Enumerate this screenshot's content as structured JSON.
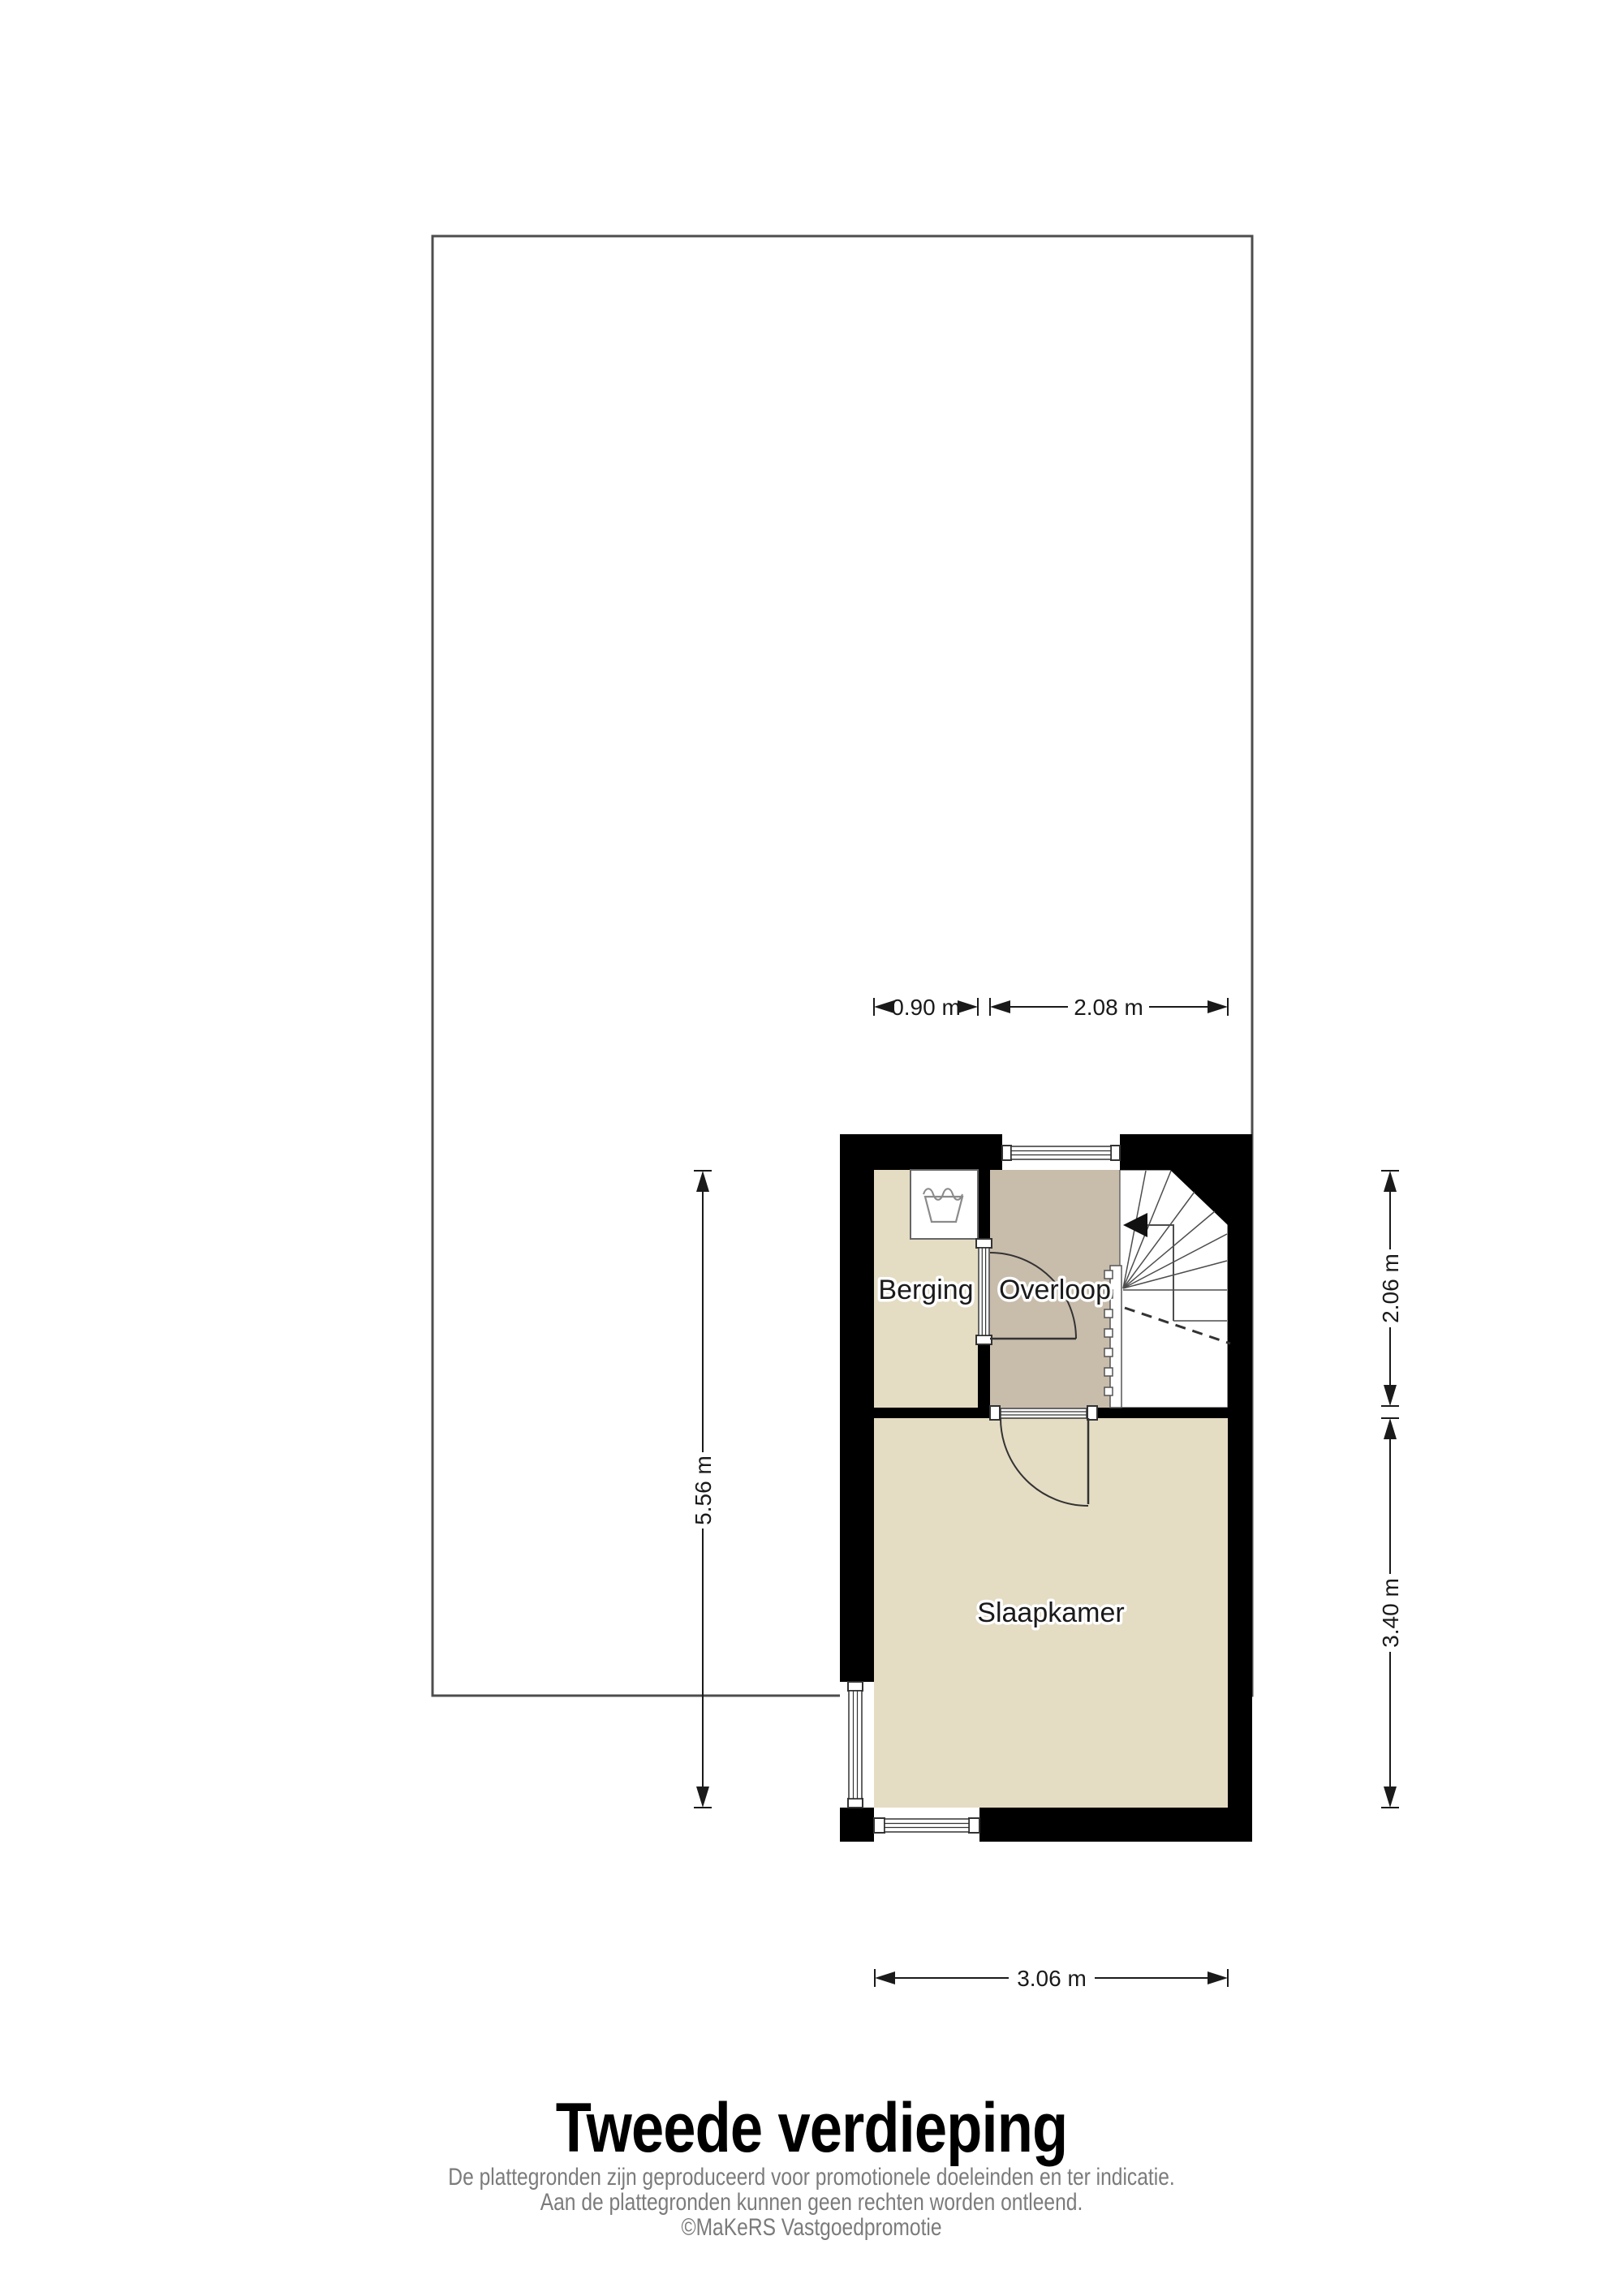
{
  "title": {
    "text": "Tweede verdieping"
  },
  "footer": {
    "line1": "De plattegronden zijn geproduceerd voor promotionele doeleinden en ter indicatie.",
    "line2": "Aan de plattegronden kunnen geen rechten worden ontleend.",
    "line3": "©MaKeRS Vastgoedpromotie"
  },
  "rooms": {
    "berging": {
      "label": "Berging"
    },
    "overloop": {
      "label": "Overloop"
    },
    "slaapkamer": {
      "label": "Slaapkamer"
    }
  },
  "dimensions": {
    "berging_width": {
      "label": "0.90 m"
    },
    "overloop_stairs_width": {
      "label": "2.08 m"
    },
    "left_inner_height": {
      "label": "5.56 m"
    },
    "overloop_height": {
      "label": "2.06 m"
    },
    "slaapkamer_height": {
      "label": "3.40 m"
    },
    "slaapkamer_width": {
      "label": "3.06 m"
    }
  },
  "icons": {
    "washbasin": "washbasin-icon",
    "stair_direction": "stair-direction-arrow-left"
  },
  "colors": {
    "floor_light": "#e4dcc3",
    "floor_dark": "#c8bcab",
    "wall": "#000000",
    "outline": "#4d4d4d",
    "dimension_ink": "#1a1a1a",
    "footer_text": "#7b7b7b"
  }
}
